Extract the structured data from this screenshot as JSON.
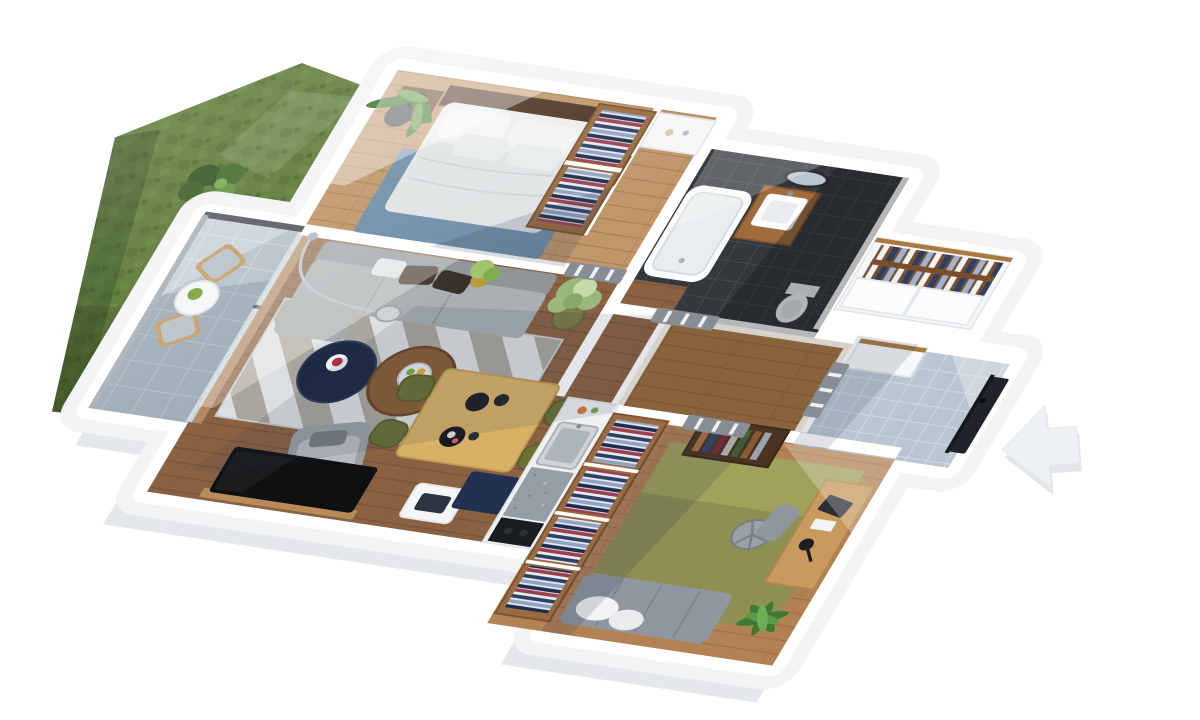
{
  "scene": {
    "kind": "3d-floor-plan-render",
    "rooms": [
      {
        "name": "garden",
        "items": [
          "lawn",
          "bush"
        ]
      },
      {
        "name": "terrace",
        "items": [
          "outdoor-chair",
          "outdoor-chair",
          "round-table",
          "banana-plant",
          "glass-railing"
        ]
      },
      {
        "name": "bedroom",
        "items": [
          "double-bed",
          "nightstand-left",
          "nightstand-right",
          "bedside-lamp",
          "palm-plant",
          "blue-rug",
          "wardrobe-with-clothes"
        ]
      },
      {
        "name": "bathroom",
        "items": [
          "bathtub",
          "wood-vanity",
          "sink",
          "round-mirror",
          "toilet"
        ]
      },
      {
        "name": "hallway",
        "items": [
          "white-dresser",
          "interior-door",
          "interior-door"
        ]
      },
      {
        "name": "living-room",
        "items": [
          "gray-sofa",
          "arc-lamp",
          "chevron-rug",
          "navy-coffee-table",
          "wood-side-table",
          "fruit-bowl",
          "armchair",
          "dining-table",
          "dining-chairs",
          "potted-tree",
          "tv",
          "media-table",
          "kitchen-counter",
          "kitchen-sink",
          "stove",
          "navy-island"
        ]
      },
      {
        "name": "office",
        "items": [
          "green-rug",
          "closet-with-folded-clothes",
          "bookshelf",
          "desk",
          "laptop",
          "desk-lamp",
          "office-chair",
          "daybed",
          "palm-plant"
        ]
      },
      {
        "name": "entry-hall",
        "items": [
          "tiled-floor",
          "white-closet",
          "front-door"
        ]
      }
    ],
    "indicator": {
      "name": "entrance-arrow",
      "direction": "left"
    }
  },
  "palette": {
    "wall": "#ffffff",
    "facade": "#f2f4f6",
    "facade_shadow": "#e4e8eb",
    "grass": "#57762f",
    "grass_dark": "#4b6829",
    "wood_bedroom": "#c0966a",
    "wood_living": "#8a6242",
    "wood_corridor": "#9e7348",
    "wood_office": "#b28254",
    "tile_bath": "#34383d",
    "tile_entry": "#b9c6d1",
    "tile_terrace": "#b6c2ca",
    "rug_bedroom": "#6f8fa8",
    "rug_chevron_light": "#dcdfe1",
    "rug_chevron_dark": "#aaa69d",
    "rug_office": "#8e8f52",
    "sofa": "#aab0b2",
    "sofa_back": "#8f9598",
    "navy": "#1e2a44",
    "side_table_wood": "#8a5d36",
    "dining_table": "#d8b167",
    "chair_olive": "#6b7034",
    "closet_wood": "#9a6b3f",
    "closet_wood_dark": "#7a4e2a",
    "door_gray": "#868d94",
    "front_door": "#20242a",
    "tv": "#0e1012",
    "mattress": "#eceeee",
    "daybed": "#9097a0",
    "desk": "#c89a5e",
    "glass": "#d7e2e8",
    "arrow": "#eef1f3",
    "plant_dark": "#3e7a33",
    "plant_light": "#9ab87e"
  }
}
